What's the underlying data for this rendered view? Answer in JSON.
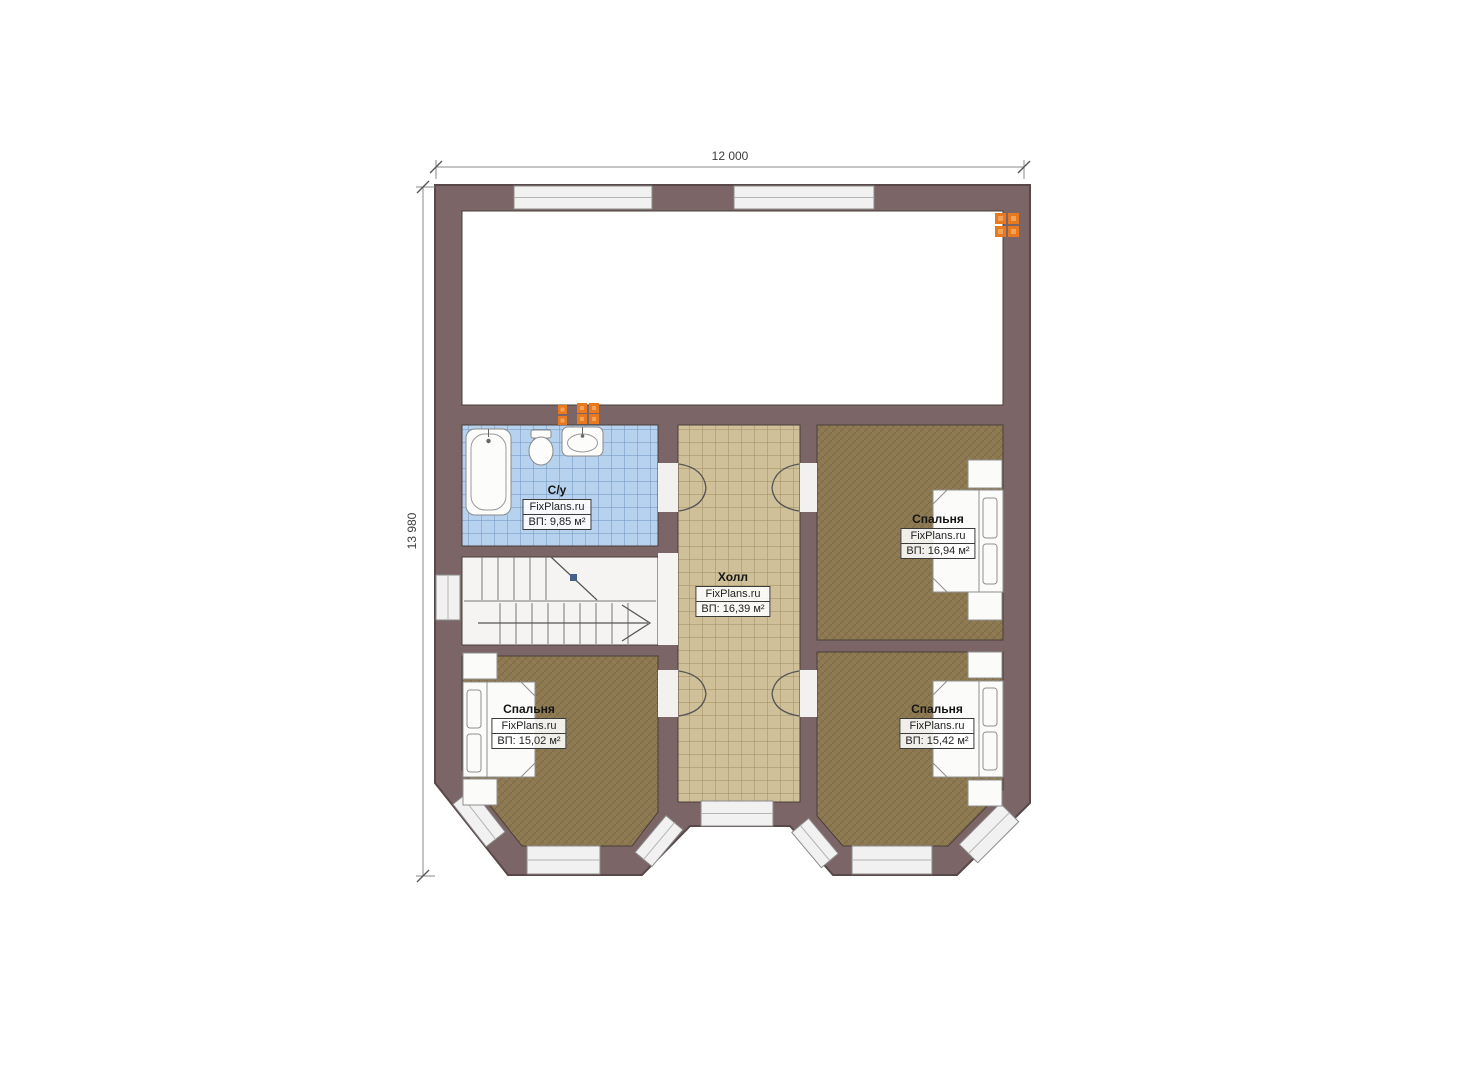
{
  "dimensions": {
    "top": "12 000",
    "left": "13 980"
  },
  "rooms": {
    "bathroom": {
      "name": "С/у",
      "brand": "FixPlans.ru",
      "area": "ВП: 9,85 м²"
    },
    "hall": {
      "name": "Холл",
      "brand": "FixPlans.ru",
      "area": "ВП: 16,39 м²"
    },
    "bedroom_top_right": {
      "name": "Спальня",
      "brand": "FixPlans.ru",
      "area": "ВП: 16,94 м²"
    },
    "bedroom_bottom_left": {
      "name": "Спальня",
      "brand": "FixPlans.ru",
      "area": "ВП: 15,02 м²"
    },
    "bedroom_bottom_right": {
      "name": "Спальня",
      "brand": "FixPlans.ru",
      "area": "ВП: 15,42 м²"
    }
  },
  "colors": {
    "wall": "#7b6566",
    "bathroom_floor": "#b6d2ef",
    "hall_floor": "#cfc099",
    "bedroom_floor": "#8d7951",
    "stair_floor": "#f5f4f2",
    "flue_accent": "#e8791e"
  }
}
